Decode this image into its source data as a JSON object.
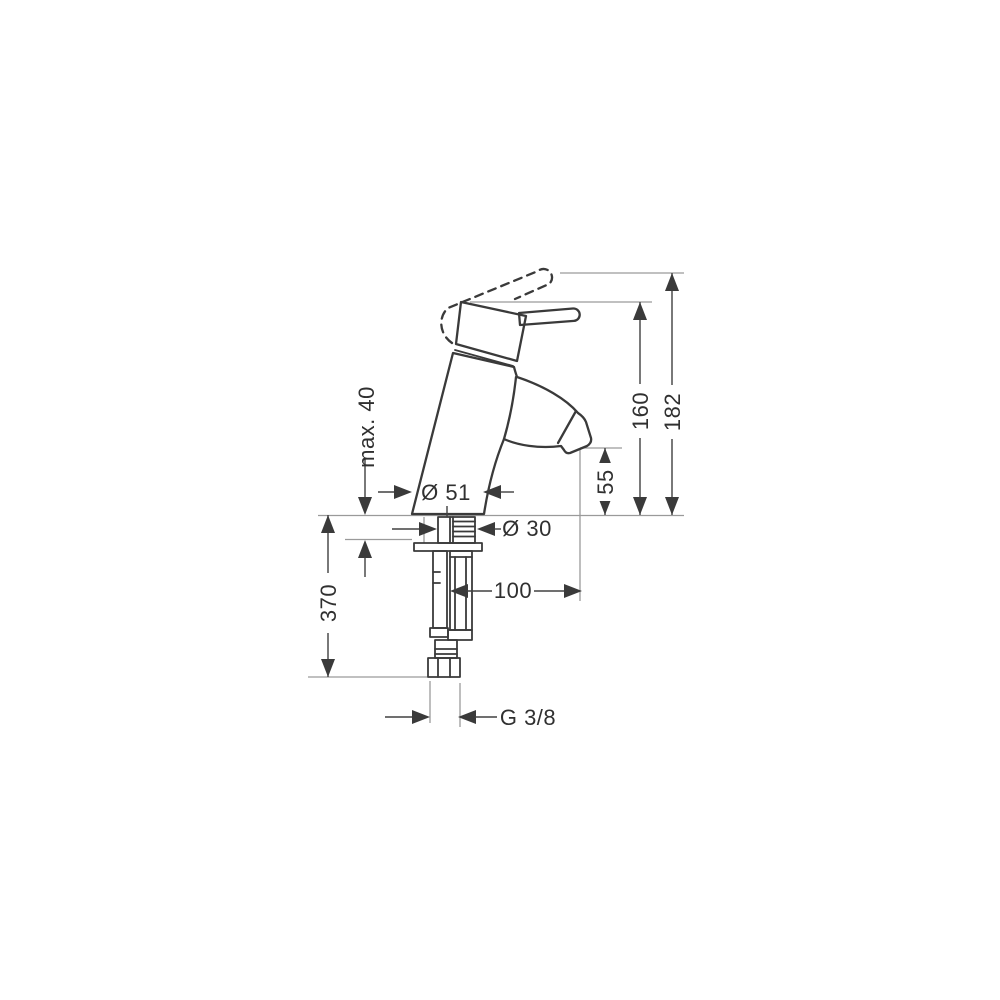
{
  "drawing": {
    "type": "technical-dimension-drawing",
    "subject": "single-lever basin mixer faucet, side elevation with mounting hardware",
    "background_color": "#ffffff",
    "object_line_color": "#3a3a3a",
    "dimension_line_color": "#404040",
    "extension_line_color": "#9a9a9a",
    "units": "mm",
    "dims": {
      "max40": "max. 40",
      "dia51": "Ø 51",
      "dia30": "Ø 30",
      "h160": "160",
      "h182": "182",
      "h55": "55",
      "v370": "370",
      "r100": "100",
      "g38": "G 3/8"
    }
  }
}
